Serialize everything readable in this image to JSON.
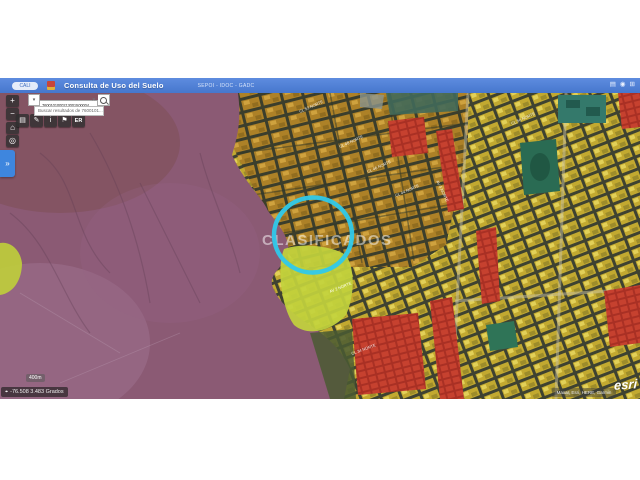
{
  "header": {
    "title": "Consulta de Uso del Suelo",
    "links": "SEPOI - IDOC - GADC",
    "logo_label": "CALI",
    "icons": {
      "layers": "▤",
      "user": "◉",
      "apps": "⊞"
    },
    "accent_color": "#4f80d5"
  },
  "search": {
    "value": "76001010002130015000040",
    "clear": "✕",
    "dropdown": "▾",
    "suggestion": "Buscar resultados de 7600101..."
  },
  "toolbar": {
    "zoom_in": "+",
    "zoom_out": "−",
    "home": "⌂",
    "locate": "◎",
    "panel": "»",
    "tools": [
      {
        "name": "basemap",
        "glyph": "▤"
      },
      {
        "name": "draw",
        "glyph": "✎"
      },
      {
        "name": "info",
        "glyph": "i"
      },
      {
        "name": "flag",
        "glyph": "⚑"
      },
      {
        "name": "er",
        "glyph": "ER"
      }
    ]
  },
  "map": {
    "watermark": "CLASIFICADOS",
    "annotation": {
      "shape": "circle",
      "color": "#2fc9ea"
    },
    "street_labels": [
      {
        "label": "CL 52 NORTE"
      },
      {
        "label": "CL 48 NORTE"
      },
      {
        "label": "CL 46 NORTE"
      },
      {
        "label": "CL 44 NORTE"
      },
      {
        "label": "AV 4 NORTE"
      },
      {
        "label": "AV 2 NORTE"
      },
      {
        "label": "CL 34 NORTE"
      },
      {
        "label": "CL 56 NORTE"
      }
    ],
    "legend_colors": {
      "conservation_purple": "#8b5a74",
      "residential_gold": "#ad8127",
      "residential_yellow": "#c2a930",
      "commercial_red": "#c6412f",
      "park_green": "#2a6b53",
      "activity_chartreuse": "#c2d23d",
      "annotation_cyan": "#2fc9ea"
    }
  },
  "statusbar": {
    "scale": "400m",
    "coordinates": "-76.508 3.483 Grados",
    "crosshair": "⌖",
    "attribution": "Maxar, Esri, HERE, Garmin",
    "esri": "esri"
  }
}
